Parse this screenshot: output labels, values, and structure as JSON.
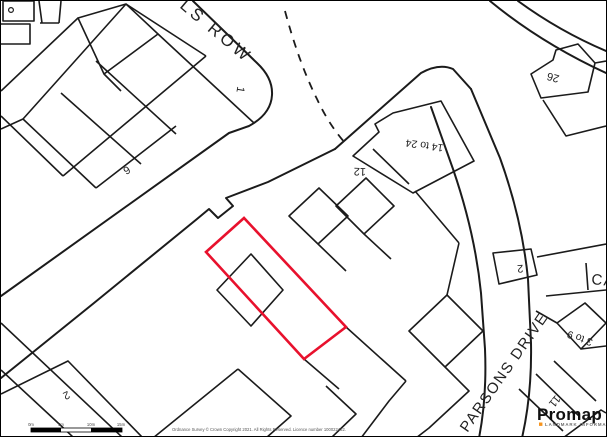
{
  "map": {
    "streets": {
      "wells_row": "LS ROW",
      "parsons_drive": "PARSONS DRIVE",
      "partial_street_east": "CA"
    },
    "plot_numbers": {
      "n1": "1",
      "n6": "6",
      "n12": "12",
      "n14_24": "14 to 24",
      "n26": "26",
      "n2_east": "2",
      "n2_southwest": "2",
      "n3_9": "3 to 9",
      "n11": "11"
    },
    "selection_color": "#E8112D",
    "line_color": "#1B1B1B"
  },
  "scale_bar": {
    "ticks": [
      "0m",
      "5m",
      "10m",
      "15m"
    ]
  },
  "footer": {
    "copyright": "Ordnance Survey © Crown Copyright 2021. All Rights Reserved. Licence number 100022432."
  },
  "branding": {
    "name": "Promap",
    "tagline": "LANDMARK INFORMATION",
    "accent_color": "#F7941D"
  }
}
